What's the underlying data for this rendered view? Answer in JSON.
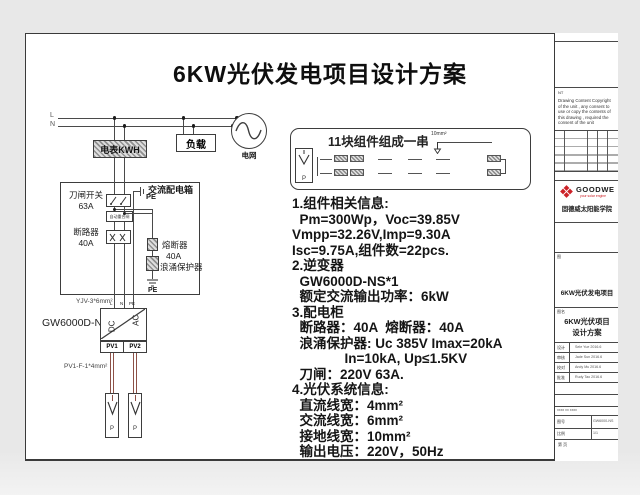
{
  "title": "6KW光伏发电项目设计方案",
  "circuit": {
    "l": "L",
    "n": "N",
    "meter": "电表KWH",
    "load": "负载",
    "grid": "电网",
    "acbox_title": "交流配电箱",
    "knife_name": "刀闸开关",
    "knife_rating": "63A",
    "small_device": "自动重合闸",
    "breaker_name": "断路器",
    "breaker_rating": "40A",
    "fuse_name": "熔断器",
    "fuse_rating": "40A",
    "spd_name": "浪涌保护器",
    "pe_top": "PE",
    "pe_bottom": "PE",
    "ac_cable": "YJV-3*6mm²",
    "inverter_model": "GW6000D-NS",
    "dc": "DC",
    "ac": "AC",
    "t_l": "L",
    "t_n": "N",
    "t_pe": "PE",
    "pv1": "PV1",
    "pv2": "PV2",
    "dc_cable": "PV1-F-1*4mm²",
    "p1": "P",
    "p2": "P"
  },
  "stringbox": {
    "title": "11块组件组成一串",
    "wire": "10mm²",
    "p": "P"
  },
  "specs": [
    "1.组件相关信息:",
    "  Pm=300Wp，Voc=39.85V",
    "Vmpp=32.26V,Imp=9.30A",
    "Isc=9.75A,组件数=22pcs.",
    "2.逆变器",
    "  GW6000D-NS*1",
    "  额定交流输出功率：6kW",
    "3.配电柜",
    "  断路器：40A  熔断器：40A",
    "  浪涌保护器: Uc 385V Imax=20kA",
    "              In=10kA, Up≤1.5KV",
    "  刀闸：220V 63A.",
    "4.光伏系统信息:",
    "  直流线宽：4mm²",
    "  交流线宽：6mm²",
    "  接地线宽：10mm²",
    "  输出电压：220V，50Hz"
  ],
  "titleblock": {
    "top": "知识产权",
    "note_tag": "NT",
    "copyright": "Drawing Content Copyright of the unit , any consent to use or copy the contents of this drawing , required the consent of the unit",
    "rev_caption": "标记 处数 更改文件号 签名 日期",
    "brand": "GOODWE",
    "tagline": "your solar engine",
    "org": "固德威太阳能学院",
    "doc_tag1": "图",
    "project": "6KW光伏发电项目",
    "doc_tag2": "图名",
    "drawing1": "6KW光伏项目",
    "drawing2": "设计方案",
    "sigs": [
      {
        "k": "设计",
        "v": "Sele Yue  2016.6"
      },
      {
        "k": "审核",
        "v": "Jade Sun  2016.6"
      },
      {
        "k": "校对",
        "v": "Andy Mu  2016.6"
      },
      {
        "k": "批准",
        "v": "Rudy Tao  2016.6"
      }
    ],
    "stage_caption": "xxxx xx xxxx",
    "g_r1l": "图号",
    "g_r1r": "GW6000-NS",
    "g_r2l": "比例",
    "g_r2r": "1/1",
    "page": "第  页"
  },
  "colors": {
    "accent_red": "#cc2127",
    "wire_red": "#8d5147"
  }
}
